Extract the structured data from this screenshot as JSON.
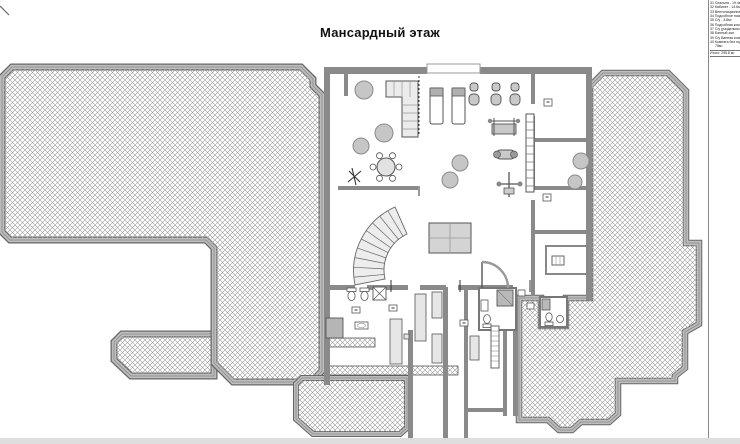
{
  "title": "Мансардный этаж",
  "legend": {
    "items": [
      "31 Спальня - 19.4м²",
      "32 Кабинет - 14.6м²",
      "33 Вентиляционная",
      "34 Подсобное пом.",
      "35 С/у - 3.8м²",
      "36 Подсобная комн.",
      "37 С/у (раздельный)",
      "38 Банный зал",
      "39 С/у Ванная комн.",
      "40 Комната без отд. -",
      "78м²"
    ],
    "total": "Итого: 295.8 м²"
  },
  "colors": {
    "hatch_line": "#9b9b9b",
    "roof_band": "#bdbdbd",
    "roof_edge": "#666666",
    "wall": "#8a8a8a",
    "furniture_outline": "#555555",
    "title_text": "#111111",
    "background": "#ffffff"
  }
}
